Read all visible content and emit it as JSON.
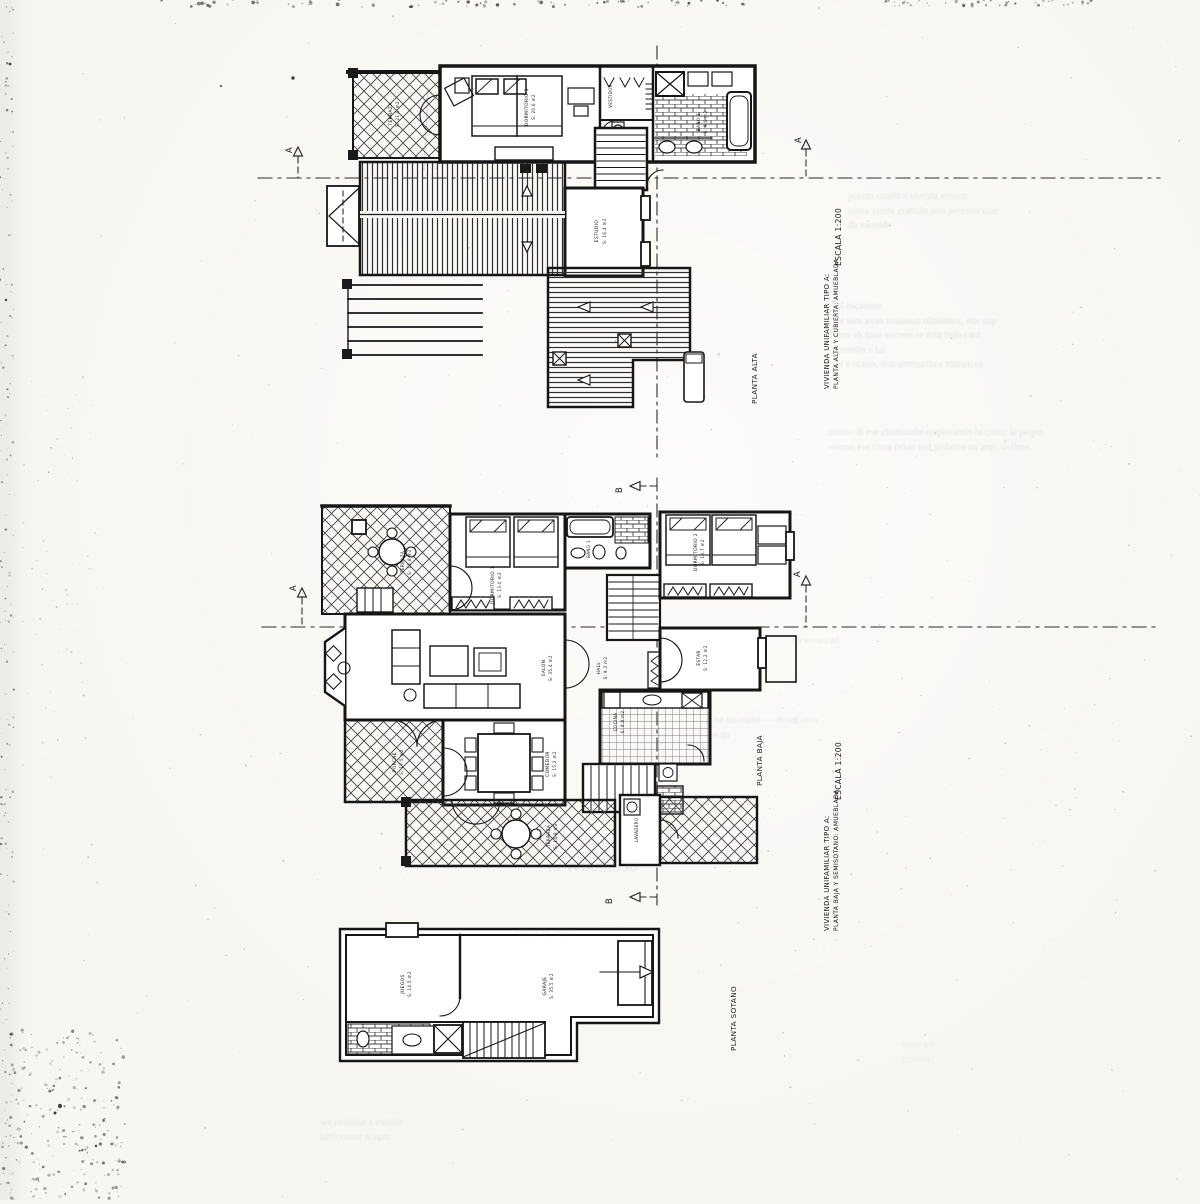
{
  "document": {
    "kind": "scanned architectural plan sheet",
    "plans": [
      {
        "id": "planta-alta",
        "title": "PLANTA ALTA"
      },
      {
        "id": "planta-baja",
        "title": "PLANTA BAJA"
      },
      {
        "id": "planta-sotano",
        "title": "PLANTA SOTANO"
      }
    ],
    "title_blocks": [
      {
        "project": "VIVIENDA UNIFAMILIAR TIPO A:",
        "sheet": "PLANTA ALTA Y CUBIERTA: AMUEBLADA",
        "scale": "ESCALA 1:200"
      },
      {
        "project": "VIVIENDA UNIFAMILIAR TIPO A:",
        "sheet": "PLANTA BAJA Y SEMISOTANO: AMUEBLADA",
        "scale": "ESCALA 1:200"
      }
    ],
    "section_markers": [
      "A",
      "A",
      "A",
      "A",
      "B",
      "B"
    ],
    "ink_color": "#1a1a1a",
    "paper_color": "#f7f6f2"
  },
  "labels": [
    {
      "text": "PLANTA ALTA",
      "x": 757,
      "y": 404,
      "rot": -90,
      "size": 7.2,
      "anchor": "start",
      "name": "plan-title-alta"
    },
    {
      "text": "PLANTA BAJA",
      "x": 762,
      "y": 786,
      "rot": -90,
      "size": 7.2,
      "anchor": "start",
      "name": "plan-title-baja"
    },
    {
      "text": "PLANTA SOTANO",
      "x": 736,
      "y": 1051,
      "rot": -90,
      "size": 7.2,
      "anchor": "start",
      "name": "plan-title-sotano"
    },
    {
      "text": "ESCALA 1:200",
      "x": 841,
      "y": 266,
      "rot": -90,
      "size": 7.5,
      "anchor": "start",
      "name": "scale-note-top"
    },
    {
      "text": "VIVIENDA UNIFAMILIAR TIPO A:",
      "x": 829,
      "y": 389,
      "rot": -90,
      "size": 6.8,
      "anchor": "start",
      "name": "titleblock-top-line1"
    },
    {
      "text": "PLANTA ALTA Y CUBIERTA: AMUEBLADA",
      "x": 838,
      "y": 389,
      "rot": -90,
      "size": 6.0,
      "anchor": "start",
      "name": "titleblock-top-line2"
    },
    {
      "text": "ESCALA 1:200",
      "x": 841,
      "y": 800,
      "rot": -90,
      "size": 7.5,
      "anchor": "start",
      "name": "scale-note-bottom"
    },
    {
      "text": "VIVIENDA UNIFAMILIAR TIPO A:",
      "x": 829,
      "y": 931,
      "rot": -90,
      "size": 6.8,
      "anchor": "start",
      "name": "titleblock-bottom-line1"
    },
    {
      "text": "PLANTA BAJA Y SEMISOTANO: AMUEBLADA",
      "x": 838,
      "y": 931,
      "rot": -90,
      "size": 6.0,
      "anchor": "start",
      "name": "titleblock-bottom-line2"
    },
    {
      "text": "A",
      "x": 292,
      "y": 150,
      "rot": -90,
      "size": 8.5,
      "anchor": "middle",
      "name": "section-marker-a"
    },
    {
      "text": "A",
      "x": 801,
      "y": 140,
      "rot": -90,
      "size": 8.5,
      "anchor": "middle",
      "name": "section-marker-a"
    },
    {
      "text": "A",
      "x": 296,
      "y": 588,
      "rot": -90,
      "size": 8.5,
      "anchor": "middle",
      "name": "section-marker-a"
    },
    {
      "text": "A",
      "x": 800,
      "y": 574,
      "rot": -90,
      "size": 8.5,
      "anchor": "middle",
      "name": "section-marker-a"
    },
    {
      "text": "B",
      "x": 622,
      "y": 490,
      "rot": -90,
      "size": 8.5,
      "anchor": "middle",
      "name": "section-marker-b"
    },
    {
      "text": "B",
      "x": 612,
      "y": 901,
      "rot": -90,
      "size": 8.5,
      "anchor": "middle",
      "name": "section-marker-b"
    },
    {
      "text": "TERRAZA",
      "x": 392,
      "y": 114,
      "rot": -90,
      "size": 4.4,
      "anchor": "middle",
      "name": "room-label"
    },
    {
      "text": "S: 21.0 m2",
      "x": 399,
      "y": 114,
      "rot": -90,
      "size": 4.0,
      "anchor": "middle",
      "name": "room-label"
    },
    {
      "text": "DORMITORIO 1",
      "x": 528,
      "y": 107,
      "rot": -90,
      "size": 4.4,
      "anchor": "middle",
      "name": "room-label"
    },
    {
      "text": "S: 20.6 m2",
      "x": 535,
      "y": 107,
      "rot": -90,
      "size": 4.0,
      "anchor": "middle",
      "name": "room-label"
    },
    {
      "text": "VESTIDOR",
      "x": 612,
      "y": 96,
      "rot": -90,
      "size": 4.0,
      "anchor": "middle",
      "name": "room-label"
    },
    {
      "text": "BAÑO 1",
      "x": 700,
      "y": 122,
      "rot": -90,
      "size": 4.2,
      "anchor": "middle",
      "name": "room-label"
    },
    {
      "text": "S: 9.6 m2",
      "x": 707,
      "y": 122,
      "rot": -90,
      "size": 4.0,
      "anchor": "middle",
      "name": "room-label"
    },
    {
      "text": "ESTUDIO",
      "x": 598,
      "y": 231,
      "rot": -90,
      "size": 4.4,
      "anchor": "middle",
      "name": "room-label"
    },
    {
      "text": "S: 16.4 m2",
      "x": 606,
      "y": 231,
      "rot": -90,
      "size": 4.0,
      "anchor": "middle",
      "name": "room-label"
    },
    {
      "text": "TERRAZA",
      "x": 404,
      "y": 562,
      "rot": -90,
      "size": 4.2,
      "anchor": "middle",
      "name": "room-label"
    },
    {
      "text": "S: 12.8 m2",
      "x": 411,
      "y": 562,
      "rot": -90,
      "size": 4.0,
      "anchor": "middle",
      "name": "room-label"
    },
    {
      "text": "DORMITORIO 1",
      "x": 494,
      "y": 585,
      "rot": -90,
      "size": 4.4,
      "anchor": "middle",
      "name": "room-label"
    },
    {
      "text": "S: 13.0 m2",
      "x": 501,
      "y": 585,
      "rot": -90,
      "size": 4.0,
      "anchor": "middle",
      "name": "room-label"
    },
    {
      "text": "BAÑO 1",
      "x": 590,
      "y": 549,
      "rot": -90,
      "size": 4.0,
      "anchor": "middle",
      "name": "room-label"
    },
    {
      "text": "DORMITORIO 2",
      "x": 697,
      "y": 552,
      "rot": -90,
      "size": 4.4,
      "anchor": "middle",
      "name": "room-label"
    },
    {
      "text": "S: 13.7 m2",
      "x": 704,
      "y": 552,
      "rot": -90,
      "size": 4.0,
      "anchor": "middle",
      "name": "room-label"
    },
    {
      "text": "SALON",
      "x": 545,
      "y": 668,
      "rot": -90,
      "size": 4.4,
      "anchor": "middle",
      "name": "room-label"
    },
    {
      "text": "S: 35.4 m2",
      "x": 552,
      "y": 668,
      "rot": -90,
      "size": 4.0,
      "anchor": "middle",
      "name": "room-label"
    },
    {
      "text": "HALL",
      "x": 600,
      "y": 668,
      "rot": -90,
      "size": 4.2,
      "anchor": "middle",
      "name": "room-label"
    },
    {
      "text": "S: 9.3 m2",
      "x": 607,
      "y": 668,
      "rot": -90,
      "size": 4.0,
      "anchor": "middle",
      "name": "room-label"
    },
    {
      "text": "ESTAR",
      "x": 700,
      "y": 658,
      "rot": -90,
      "size": 4.2,
      "anchor": "middle",
      "name": "room-label"
    },
    {
      "text": "S: 12.2 m2",
      "x": 707,
      "y": 658,
      "rot": -90,
      "size": 4.0,
      "anchor": "middle",
      "name": "room-label"
    },
    {
      "text": "COCINA",
      "x": 617,
      "y": 722,
      "rot": -90,
      "size": 4.2,
      "anchor": "middle",
      "name": "room-label"
    },
    {
      "text": "S: 9.9 m2",
      "x": 624,
      "y": 722,
      "rot": -90,
      "size": 4.0,
      "anchor": "middle",
      "name": "room-label"
    },
    {
      "text": "COMEDOR",
      "x": 549,
      "y": 764,
      "rot": -90,
      "size": 4.4,
      "anchor": "middle",
      "name": "room-label"
    },
    {
      "text": "S: 15.2 m2",
      "x": 556,
      "y": 764,
      "rot": -90,
      "size": 4.0,
      "anchor": "middle",
      "name": "room-label"
    },
    {
      "text": "PORCHE",
      "x": 396,
      "y": 762,
      "rot": -90,
      "size": 4.2,
      "anchor": "middle",
      "name": "room-label"
    },
    {
      "text": "S: 17.5 m2",
      "x": 403,
      "y": 762,
      "rot": -90,
      "size": 4.0,
      "anchor": "middle",
      "name": "room-label"
    },
    {
      "text": "TERRAZA",
      "x": 550,
      "y": 836,
      "rot": -90,
      "size": 4.2,
      "anchor": "middle",
      "name": "room-label"
    },
    {
      "text": "S: 14.8 m2",
      "x": 557,
      "y": 836,
      "rot": -90,
      "size": 4.0,
      "anchor": "middle",
      "name": "room-label"
    },
    {
      "text": "LAVADERO",
      "x": 638,
      "y": 830,
      "rot": -90,
      "size": 4.0,
      "anchor": "middle",
      "name": "room-label"
    },
    {
      "text": "JUEGOS",
      "x": 404,
      "y": 984,
      "rot": -90,
      "size": 4.4,
      "anchor": "middle",
      "name": "room-label"
    },
    {
      "text": "S: 14.5 m2",
      "x": 411,
      "y": 984,
      "rot": -90,
      "size": 4.0,
      "anchor": "middle",
      "name": "room-label"
    },
    {
      "text": "GARAJE",
      "x": 546,
      "y": 986,
      "rot": -90,
      "size": 4.4,
      "anchor": "middle",
      "name": "room-label"
    },
    {
      "text": "S: 35.5 m2",
      "x": 553,
      "y": 986,
      "rot": -90,
      "size": 4.0,
      "anchor": "middle",
      "name": "room-label"
    }
  ],
  "bleed_text": [
    {
      "x": 848,
      "y": 190,
      "size": 10,
      "opacity": 0.15,
      "lines": [
        "porem conett a oberriz ennum",
        "suniv ecuns erattulo von perenna iam",
        "da escende"
      ]
    },
    {
      "x": 836,
      "y": 300,
      "size": 10,
      "opacity": 0.16,
      "lines": [
        "ol escasone",
        "se tero avan conassut oluminen, ede sup",
        "eno ab inne sucrete se min bajo cant",
        "recedin o tai",
        "ta e ocaso, non ammurdo e manen es"
      ]
    },
    {
      "x": 828,
      "y": 426,
      "size": 10,
      "opacity": 0.15,
      "lines": [
        "animo di ese chumando emplerando la cinto, la peqen",
        "wenno ese cima celan sed pedanto na imp, se ilme"
      ]
    },
    {
      "x": 792,
      "y": 634,
      "size": 9,
      "opacity": 0.12,
      "lines": [
        "im nocum ad"
      ]
    },
    {
      "x": 706,
      "y": 714,
      "size": 10,
      "opacity": 0.13,
      "lines": [
        "a ise nu sorbe — dvom ossv",
        "me tis"
      ]
    },
    {
      "x": 548,
      "y": 858,
      "size": 13,
      "opacity": 0.16,
      "lines": [
        "IU 'IVBUILL  3U"
      ]
    },
    {
      "x": 516,
      "y": 924,
      "size": 12,
      "opacity": 0.12,
      "lines": [
        "uena es ehse"
      ]
    },
    {
      "x": 320,
      "y": 1116,
      "size": 10,
      "opacity": 0.13,
      "lines": [
        "we censene a extotto",
        "latticemon ecosto"
      ]
    },
    {
      "x": 902,
      "y": 1038,
      "size": 10,
      "opacity": 0.1,
      "lines": [
        "enne ath",
        "missen"
      ]
    }
  ]
}
